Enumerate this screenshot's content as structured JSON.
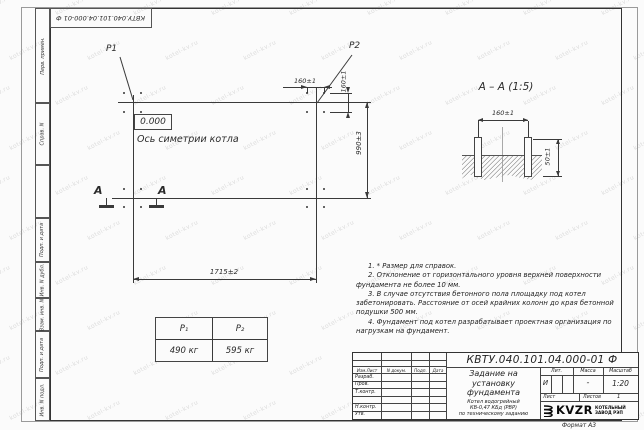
{
  "corner_stamp": {
    "text": "КВТУ.040.101.04.000-01  Ф"
  },
  "side_column": {
    "items": [
      "Перв. примен.",
      "Справ. N",
      "Подп. и дата",
      "Инв. N дубл.",
      "Взам. инв. N",
      "Подп. и дата",
      "Инв. N подл."
    ]
  },
  "plan": {
    "p1_label": "P1",
    "p2_label": "P2",
    "level_mark": "0.000",
    "axis_label": "Ось симетрии котла",
    "section_letter": "А",
    "dim_width": "1715±2",
    "dim_height": "990±3",
    "dim_bolt_spacing_h": "160±1",
    "dim_bolt_spacing_v": "160±1"
  },
  "section_view": {
    "title": "А – А (1:5)",
    "dim_bolt_spacing": "160±1",
    "dim_protrusion": "50±1"
  },
  "load_table": {
    "col1_header": "P₁",
    "col2_header": "P₂",
    "col1_value": "490 кг",
    "col2_value": "595 кг"
  },
  "notes": {
    "n1": "1. * Размер для справок.",
    "n2": "2. Отклонение от горизонтального уровня верхней поверхности фундамента не более 10 мм.",
    "n3": "3. В случае отсутствия бетонного пола площадку под котел забетонировать. Расстояние от осей крайних колонн до края бетонной подушки 500 мм.",
    "n4": "4. Фундамент под котел разрабатывает проектная организация по нагрузкам на фундамент."
  },
  "title_block": {
    "doc_number": "КВТУ.040.101.04.000-01  Ф",
    "title_line1": "Задание на",
    "title_line2": "установку",
    "title_line3": "фундамента",
    "subtitle_line1": "Котел водогрейный",
    "subtitle_line2": "КВ-0,47 КБд (РВР)",
    "subtitle_line3": "по техническому заданию",
    "col_izm": "Изм.Лист",
    "col_doc": "N докум.",
    "col_podp": "Подп.",
    "col_data": "Дата",
    "row_razrab": "Разраб.",
    "row_prov": "Пров.",
    "row_tkontr": "Т.контр.",
    "row_nkontr": "Н.контр.",
    "row_utv": "Утв.",
    "lit_label": "Лит.",
    "lit_value": "И",
    "mass_label": "Масса",
    "mass_value": "-",
    "scale_label": "Масштаб",
    "scale_value": "1:20",
    "sheet_label": "Лист",
    "sheets_label": "Листов",
    "sheets_value": "1",
    "logo_text": "KVZR",
    "company_line1": "КОТЕЛЬНЫЙ",
    "company_line2": "ЗАВОД РЭП",
    "format_label": "Формат А3"
  },
  "watermark": {
    "text": "kotel-kv.ru"
  },
  "colors": {
    "line": "#3a3a3a",
    "watermark": "#dcdcdc",
    "paper": "#fbfbfb"
  }
}
